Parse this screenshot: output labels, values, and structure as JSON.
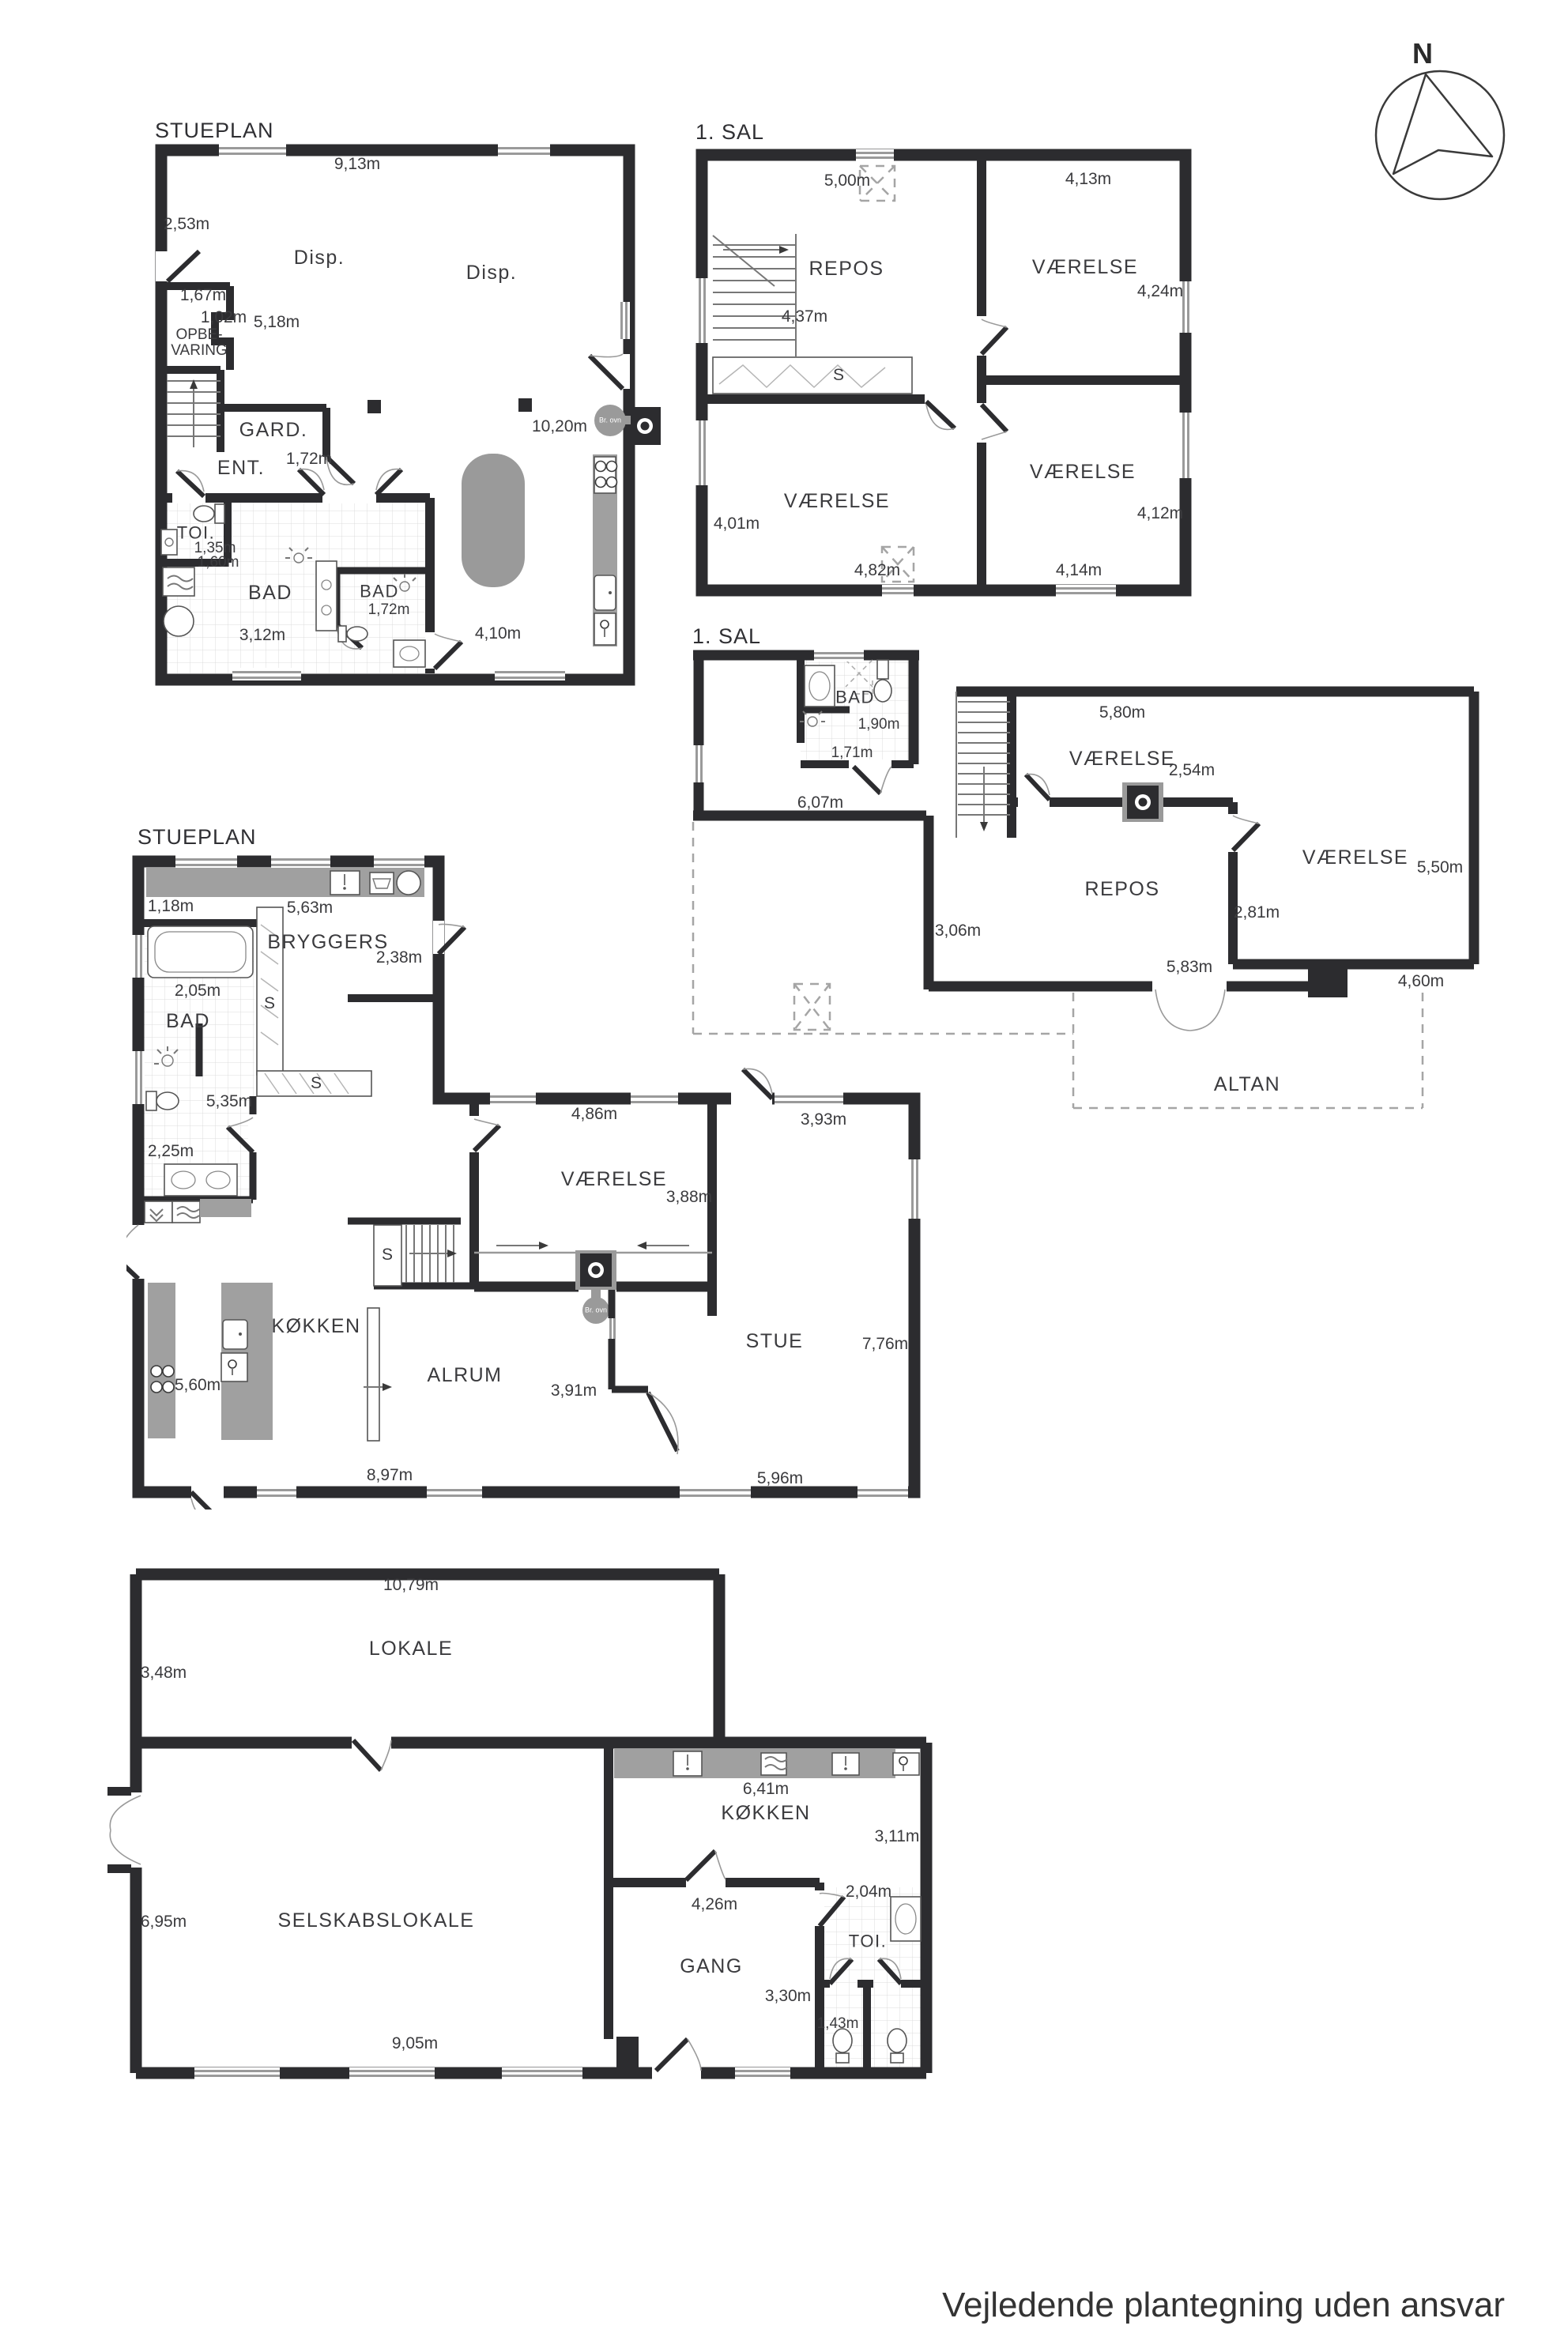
{
  "footer": "Vejledende plantegning uden ansvar",
  "compass": {
    "north_label": "N"
  },
  "p1": {
    "title": "STUEPLAN",
    "rooms": [
      "Disp.",
      "Disp.",
      "OPBE-",
      "VARING",
      "GARD.",
      "ENT.",
      "TOI.",
      "BAD",
      "BAD"
    ],
    "dims": [
      "9,13m",
      "2,53m",
      "1,67m",
      "1,02m",
      "5,18m",
      "1,72m",
      "10,20m",
      "1,35m",
      "1,60m",
      "3,12m",
      "1,72m",
      "4,10m"
    ],
    "stove": "Br. ovn"
  },
  "p2": {
    "title": "1. SAL",
    "rooms": [
      "REPOS",
      "VÆRELSE",
      "VÆRELSE",
      "VÆRELSE"
    ],
    "closet": "S",
    "dims": [
      "5,00m",
      "4,13m",
      "4,24m",
      "4,37m",
      "4,01m",
      "4,82m",
      "4,14m",
      "4,12m"
    ]
  },
  "p3": {
    "title": "1. SAL",
    "rooms": [
      "BAD",
      "VÆRELSE",
      "VÆRELSE",
      "REPOS",
      "ALTAN"
    ],
    "dims": [
      "1,90m",
      "1,71m",
      "6,07m",
      "5,80m",
      "2,54m",
      "5,50m",
      "3,06m",
      "5,83m",
      "2,81m",
      "4,60m"
    ]
  },
  "p4": {
    "title": "STUEPLAN",
    "rooms": [
      "BRYGGERS",
      "BAD",
      "KØKKEN",
      "ALRUM",
      "VÆRELSE",
      "STUE"
    ],
    "closets": [
      "S",
      "S",
      "S"
    ],
    "dims": [
      "1,18m",
      "5,63m",
      "2,38m",
      "2,05m",
      "5,35m",
      "2,25m",
      "5,60m",
      "4,86m",
      "3,88m",
      "3,93m",
      "7,76m",
      "3,91m",
      "8,97m",
      "5,96m"
    ],
    "stove": "Br. ovn"
  },
  "p5": {
    "rooms": [
      "LOKALE",
      "KØKKEN",
      "GANG",
      "TOI.",
      "SELSKABSLOKALE"
    ],
    "dims": [
      "10,79m",
      "3,48m",
      "6,41m",
      "3,11m",
      "4,26m",
      "2,04m",
      "3,30m",
      "1,43m",
      "6,95m",
      "9,05m"
    ]
  }
}
